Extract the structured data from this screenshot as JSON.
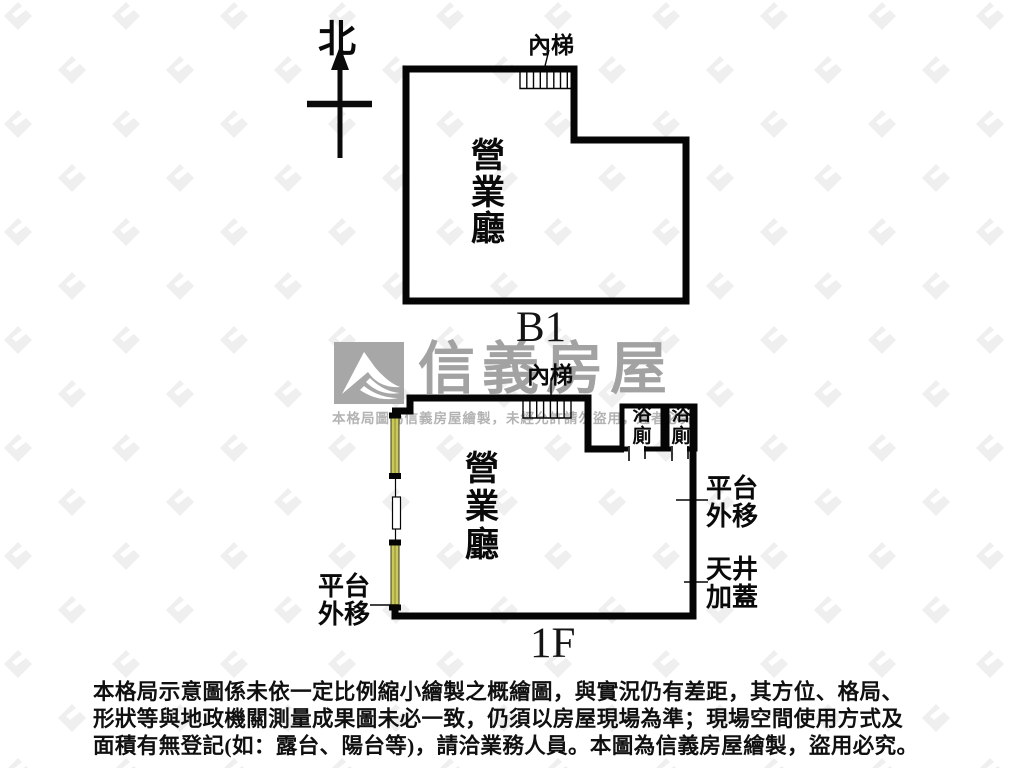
{
  "north": {
    "label": "北",
    "icon": "north-arrow-icon"
  },
  "watermark": {
    "logo_icon": "sinyi-mountain-logo",
    "brand": "信義房屋",
    "notice": "本格局圖為信義房屋繪製，未經允許請勿盜用，違者必究"
  },
  "floors": {
    "b1": {
      "floor_name": "B1",
      "room": "營業廳",
      "stairs": "內梯"
    },
    "f1": {
      "floor_name": "1F",
      "room": "營業廳",
      "stairs": "內梯",
      "bathroom_1": "浴廁",
      "bathroom_2": "浴廁",
      "left_annotation": "平台\n外移",
      "right_annotation_platform": "平台\n外移",
      "right_annotation_skylight": "天井\n加蓋"
    }
  },
  "disclaimer": {
    "lines": [
      "本格局示意圖係未依一定比例縮小繪製之概繪圖，與實況仍有差距，其方位、格局、",
      "形狀等與地政機關測量成果圖未必一致，仍須以房屋現場為準；現場空間使用方式及",
      "面積有無登記(如：露台、陽台等)，請洽業務人員。本圖為信義房屋繪製，盜用必究。"
    ]
  },
  "colors": {
    "wall": "#050505",
    "window_fill": "#c9c95c",
    "brand_gray": "#a2a2a2",
    "notice_gray": "#b3b3b3",
    "background_pattern": "#ededed"
  }
}
